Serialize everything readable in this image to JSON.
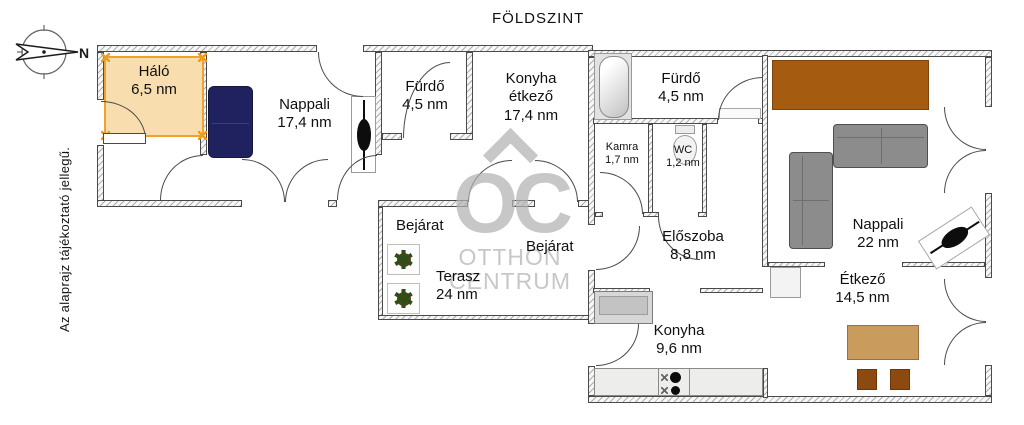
{
  "title": "FÖLDSZINT",
  "disclaimer": "Az alaprajz tájékoztató jellegű.",
  "compass": {
    "label": "N"
  },
  "watermark": {
    "letters": "OC",
    "line1": "OTTHON",
    "line2": "CENTRUM"
  },
  "icons": {
    "plant": "✱"
  },
  "colors": {
    "highlight_fill": "#F8DEAE",
    "highlight_border": "#F0A22A",
    "sofa_navy": "#20225F",
    "cabinet_brown": "#A55C11",
    "table_tan": "#C99B5D",
    "chair_brown": "#8C4A10",
    "sofa_gray": "#8C8C8C",
    "watermark_gray": "#B2B2B2"
  },
  "rooms": [
    {
      "name": "Háló",
      "area": "6,5 nm",
      "highlighted": true
    },
    {
      "name": "Nappali",
      "area": "17,4 nm"
    },
    {
      "name": "Fürdő",
      "area": "4,5 nm"
    },
    {
      "name_lines": [
        "Konyha",
        "étkező"
      ],
      "area": "17,4 nm"
    },
    {
      "name": "Fürdő",
      "area": "4,5 nm"
    },
    {
      "name": "Kamra",
      "area": "1,7 nm"
    },
    {
      "name": "WC",
      "area": "1,2 nm"
    },
    {
      "name": "Előszoba",
      "area": "8,8 nm"
    },
    {
      "name": "Konyha",
      "area": "9,6 nm"
    },
    {
      "name": "Nappali",
      "area": "22 nm"
    },
    {
      "name": "Étkező",
      "area": "14,5 nm"
    },
    {
      "name": "Terasz",
      "area": "24 nm"
    }
  ],
  "entrances": [
    "Bejárat",
    "Bejárat"
  ]
}
